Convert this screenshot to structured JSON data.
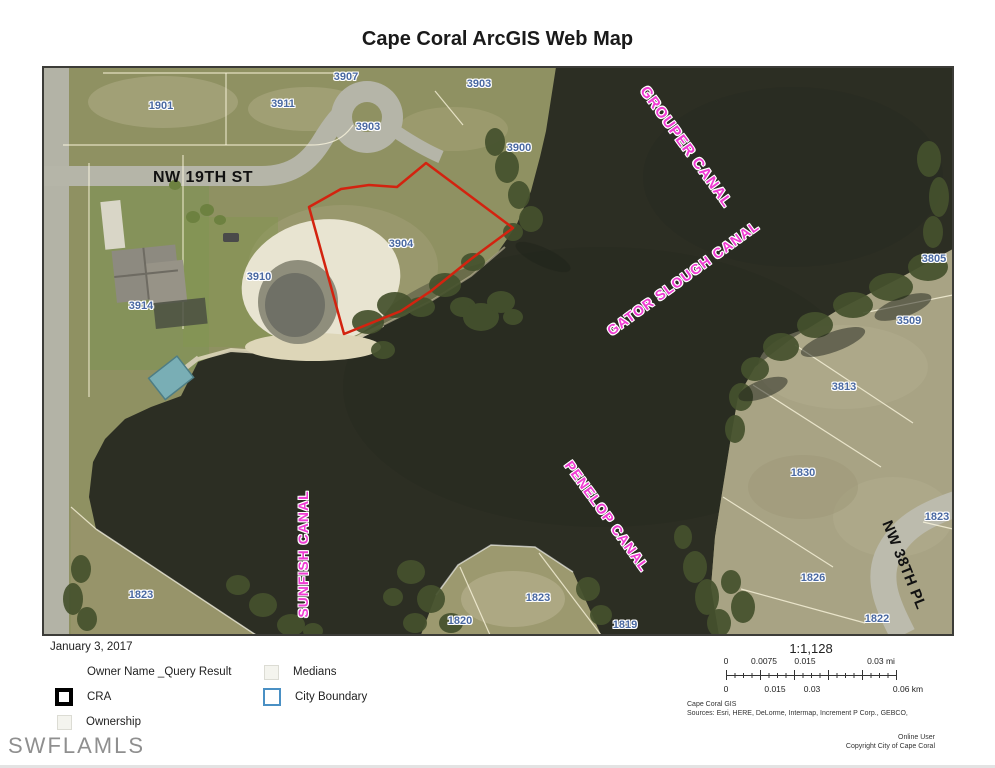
{
  "page": {
    "title": "Cape Coral ArcGIS Web Map",
    "watermark": "SWFLAMLS"
  },
  "map": {
    "street_labels": [
      {
        "text": "NW 19TH ST",
        "x": 160,
        "y": 111,
        "rotate": 0,
        "size": 16
      },
      {
        "text": "NW 38TH PL",
        "x": 861,
        "y": 498,
        "rotate": 68,
        "size": 15
      }
    ],
    "canal_labels": [
      {
        "text": "GROUPER CANAL",
        "x": 643,
        "y": 80,
        "rotate": 54,
        "size": 15
      },
      {
        "text": "GATOR SLOUGH CANAL",
        "x": 640,
        "y": 211,
        "rotate": -36,
        "size": 14
      },
      {
        "text": "SUNFISH CANAL",
        "x": 260,
        "y": 487,
        "rotate": -90,
        "size": 14
      },
      {
        "text": "PENELOP CANAL",
        "x": 564,
        "y": 449,
        "rotate": 54,
        "size": 14
      }
    ],
    "parcel_labels": [
      {
        "text": "1901",
        "x": 118,
        "y": 39
      },
      {
        "text": "3911",
        "x": 240,
        "y": 37
      },
      {
        "text": "3907",
        "x": 303,
        "y": 10
      },
      {
        "text": "3903",
        "x": 325,
        "y": 60
      },
      {
        "text": "3903",
        "x": 436,
        "y": 17
      },
      {
        "text": "3900",
        "x": 476,
        "y": 81
      },
      {
        "text": "3910",
        "x": 216,
        "y": 210
      },
      {
        "text": "3914",
        "x": 98,
        "y": 239
      },
      {
        "text": "3904",
        "x": 358,
        "y": 177
      },
      {
        "text": "3805",
        "x": 891,
        "y": 192
      },
      {
        "text": "3509",
        "x": 866,
        "y": 254
      },
      {
        "text": "3813",
        "x": 801,
        "y": 320
      },
      {
        "text": "1830",
        "x": 760,
        "y": 406
      },
      {
        "text": "1823",
        "x": 894,
        "y": 450
      },
      {
        "text": "1826",
        "x": 770,
        "y": 511
      },
      {
        "text": "1822",
        "x": 834,
        "y": 552
      },
      {
        "text": "1823",
        "x": 98,
        "y": 528
      },
      {
        "text": "1820",
        "x": 417,
        "y": 554
      },
      {
        "text": "1823",
        "x": 495,
        "y": 531
      },
      {
        "text": "1819",
        "x": 582,
        "y": 558
      }
    ]
  },
  "legend": {
    "date": "January 3, 2017",
    "items": [
      {
        "label": "Owner Name _Query Result",
        "swatch": "none",
        "x": 55,
        "y": 662
      },
      {
        "label": "CRA",
        "swatch": "cra",
        "x": 55,
        "y": 687
      },
      {
        "label": "Ownership",
        "swatch": "faint",
        "x": 57,
        "y": 712
      },
      {
        "label": "Medians",
        "swatch": "faint",
        "x": 264,
        "y": 662
      },
      {
        "label": "City Boundary",
        "swatch": "city",
        "x": 263,
        "y": 687
      }
    ]
  },
  "scale": {
    "ratio": "1:1,128",
    "mi_labels": [
      {
        "text": "0",
        "x": 0
      },
      {
        "text": "0.0075",
        "x": 38
      },
      {
        "text": "0.015",
        "x": 79
      },
      {
        "text": "0.03 mi",
        "x": 155
      }
    ],
    "km_labels": [
      {
        "text": "0",
        "x": 0
      },
      {
        "text": "0.015",
        "x": 49
      },
      {
        "text": "0.03",
        "x": 86
      },
      {
        "text": "0.06 km",
        "x": 182
      }
    ]
  },
  "credits": {
    "gis": "Cape Coral GIS",
    "sources": "Sources: Esri, HERE, DeLorme, Intermap, Increment P Corp., GEBCO,",
    "user": "Online User",
    "copyright": "Copyright City of Cape Coral"
  },
  "colors": {
    "water": "#2c2e23",
    "land": "#8f9162",
    "land_right": "#a8a384",
    "road": "#b5b5a8",
    "parcel_outline_red": "#d3230f",
    "canal_text": "#ef3bd3",
    "parcel_label_text": "#4a69a2",
    "city_boundary_blue": "#4a90c4"
  }
}
